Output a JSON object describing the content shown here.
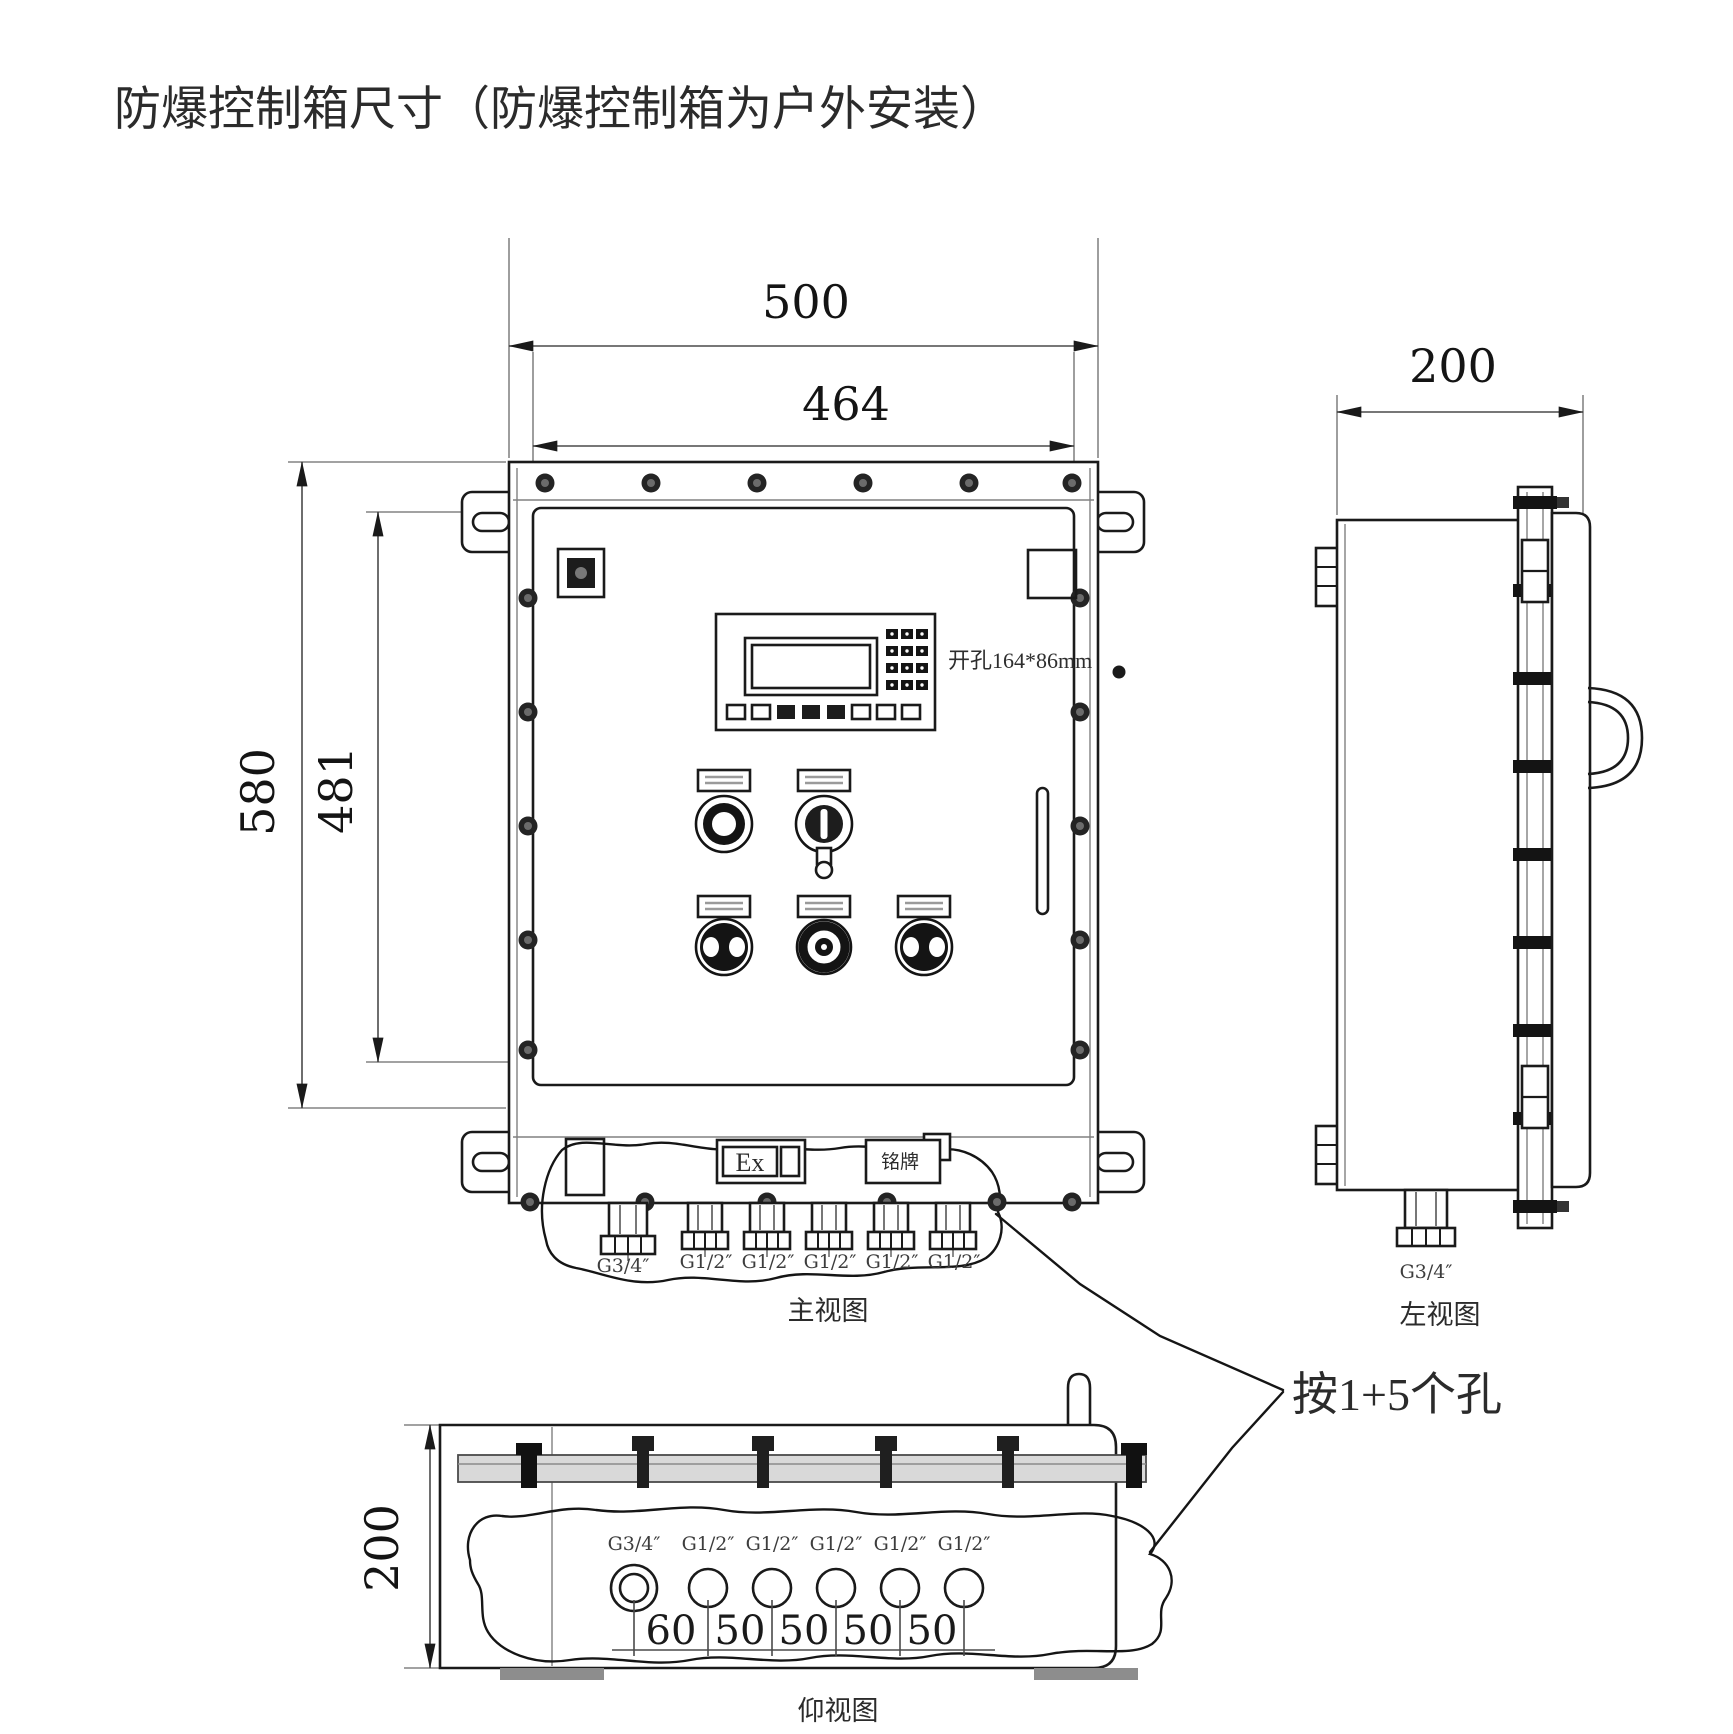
{
  "title": "防爆控制箱尺寸（防爆控制箱为户外安装）",
  "front_view": {
    "view_label": "主视图",
    "dim_outer_width": "500",
    "dim_inner_width": "464",
    "dim_outer_height": "580",
    "dim_inner_height": "481",
    "cutout_note": "开孔164*86mm",
    "ex_mark": "Ex",
    "nameplate": "铭牌",
    "gland_labels": [
      "G3/4″",
      "G1/2″",
      "G1/2″",
      "G1/2″",
      "G1/2″",
      "G1/2″"
    ]
  },
  "side_view": {
    "view_label": "左视图",
    "dim_depth": "200",
    "gland_label": "G3/4″"
  },
  "bottom_view": {
    "view_label": "仰视图",
    "dim_depth": "200",
    "gland_labels": [
      "G3/4″",
      "G1/2″",
      "G1/2″",
      "G1/2″",
      "G1/2″",
      "G1/2″"
    ],
    "hole_spacings": [
      "60",
      "50",
      "50",
      "50",
      "50"
    ]
  },
  "annotation": {
    "holes_note": "按1+5个孔"
  }
}
